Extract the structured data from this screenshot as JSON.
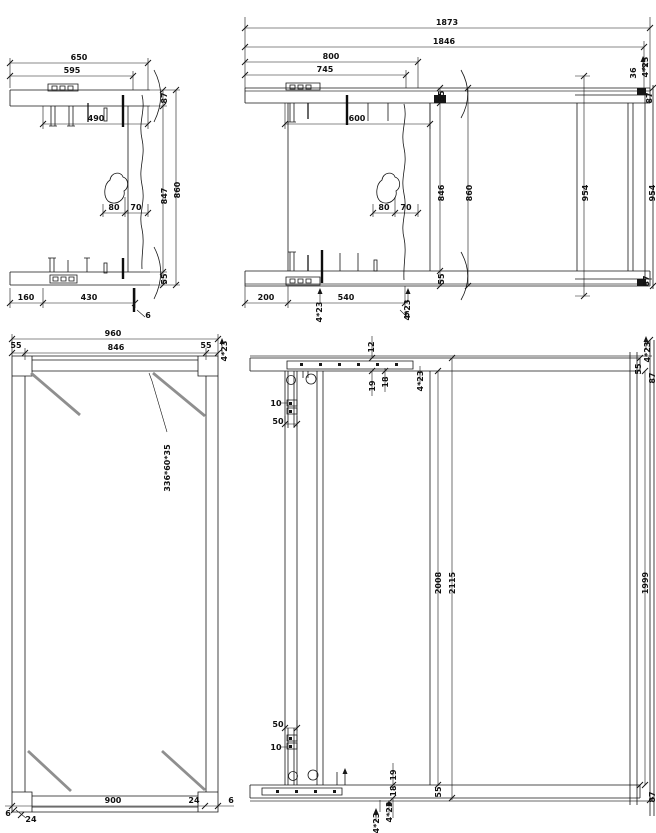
{
  "page": {
    "background": "#ffffff",
    "line_color": "#161616",
    "gray_member_color": "#9b9b9b"
  },
  "drawings": [
    {
      "id": "d1",
      "name": "end-frame-section-left",
      "labels": [
        {
          "t": "650",
          "x": 79,
          "y": 60
        },
        {
          "t": "595",
          "x": 72,
          "y": 73
        },
        {
          "t": "490",
          "x": 96,
          "y": 121
        },
        {
          "t": "80",
          "x": 114,
          "y": 210
        },
        {
          "t": "70",
          "x": 136,
          "y": 210
        },
        {
          "t": "160",
          "x": 26,
          "y": 300
        },
        {
          "t": "430",
          "x": 89,
          "y": 300
        },
        {
          "t": "6",
          "x": 148,
          "y": 318
        },
        {
          "t": "87",
          "x": 167,
          "y": 98,
          "r": 1
        },
        {
          "t": "847",
          "x": 167,
          "y": 196,
          "r": 1
        },
        {
          "t": "860",
          "x": 180,
          "y": 190,
          "r": 1
        },
        {
          "t": "55",
          "x": 167,
          "y": 279,
          "r": 1
        }
      ]
    },
    {
      "id": "d2",
      "name": "end-frame-section-full-width",
      "labels": [
        {
          "t": "1873",
          "x": 447,
          "y": 25
        },
        {
          "t": "1846",
          "x": 444,
          "y": 44
        },
        {
          "t": "800",
          "x": 331,
          "y": 59
        },
        {
          "t": "745",
          "x": 325,
          "y": 72
        },
        {
          "t": "600",
          "x": 357,
          "y": 121
        },
        {
          "t": "80",
          "x": 384,
          "y": 210
        },
        {
          "t": "70",
          "x": 406,
          "y": 210
        },
        {
          "t": "200",
          "x": 266,
          "y": 300
        },
        {
          "t": "540",
          "x": 346,
          "y": 300
        },
        {
          "t": "6",
          "x": 407,
          "y": 317
        },
        {
          "t": "4*23",
          "x": 322,
          "y": 312,
          "r": 1
        },
        {
          "t": "4*23",
          "x": 410,
          "y": 310,
          "r": 1
        },
        {
          "t": "55",
          "x": 444,
          "y": 96,
          "r": 1
        },
        {
          "t": "846",
          "x": 444,
          "y": 193,
          "r": 1
        },
        {
          "t": "55",
          "x": 444,
          "y": 279,
          "r": 1
        },
        {
          "t": "860",
          "x": 472,
          "y": 193,
          "r": 1
        },
        {
          "t": "954",
          "x": 588,
          "y": 193,
          "r": 1
        },
        {
          "t": "954",
          "x": 655,
          "y": 193,
          "r": 1
        },
        {
          "t": "36",
          "x": 636,
          "y": 73,
          "r": 1
        },
        {
          "t": "4*23",
          "x": 648,
          "y": 67,
          "r": 1
        },
        {
          "t": "87",
          "x": 652,
          "y": 98,
          "r": 1
        },
        {
          "t": "87",
          "x": 649,
          "y": 281,
          "r": 1
        }
      ]
    },
    {
      "id": "d3",
      "name": "braced-frame-elevation",
      "labels": [
        {
          "t": "960",
          "x": 113,
          "y": 336
        },
        {
          "t": "846",
          "x": 116,
          "y": 350
        },
        {
          "t": "55",
          "x": 16,
          "y": 348
        },
        {
          "t": "55",
          "x": 206,
          "y": 348
        },
        {
          "t": "4*23",
          "x": 227,
          "y": 351,
          "r": 1
        },
        {
          "t": "336*60*35",
          "x": 170,
          "y": 468,
          "r": 1
        },
        {
          "t": "900",
          "x": 113,
          "y": 803
        },
        {
          "t": "24",
          "x": 194,
          "y": 803
        },
        {
          "t": "6",
          "x": 231,
          "y": 803
        },
        {
          "t": "6",
          "x": 8,
          "y": 816
        },
        {
          "t": "24",
          "x": 31,
          "y": 822
        }
      ]
    },
    {
      "id": "d4",
      "name": "tall-frame-elevation",
      "labels": [
        {
          "t": "12",
          "x": 374,
          "y": 347,
          "r": 1
        },
        {
          "t": "19",
          "x": 375,
          "y": 386,
          "r": 1
        },
        {
          "t": "18",
          "x": 388,
          "y": 382,
          "r": 1
        },
        {
          "t": "4*23",
          "x": 423,
          "y": 381,
          "r": 1
        },
        {
          "t": "55",
          "x": 641,
          "y": 369,
          "r": 1
        },
        {
          "t": "4*23",
          "x": 650,
          "y": 352,
          "r": 1
        },
        {
          "t": "87",
          "x": 655,
          "y": 378,
          "r": 1
        },
        {
          "t": "10",
          "x": 276,
          "y": 406
        },
        {
          "t": "50",
          "x": 278,
          "y": 424
        },
        {
          "t": "2008",
          "x": 441,
          "y": 583,
          "r": 1
        },
        {
          "t": "2115",
          "x": 455,
          "y": 583,
          "r": 1
        },
        {
          "t": "1999",
          "x": 648,
          "y": 583,
          "r": 1
        },
        {
          "t": "50",
          "x": 278,
          "y": 727
        },
        {
          "t": "10",
          "x": 276,
          "y": 750
        },
        {
          "t": "19",
          "x": 396,
          "y": 775,
          "r": 1
        },
        {
          "t": "18",
          "x": 396,
          "y": 791,
          "r": 1
        },
        {
          "t": "4*23",
          "x": 392,
          "y": 812,
          "r": 1
        },
        {
          "t": "4*23",
          "x": 379,
          "y": 823,
          "r": 1
        },
        {
          "t": "55",
          "x": 441,
          "y": 792,
          "r": 1
        },
        {
          "t": "87",
          "x": 655,
          "y": 797,
          "r": 1
        }
      ]
    }
  ]
}
